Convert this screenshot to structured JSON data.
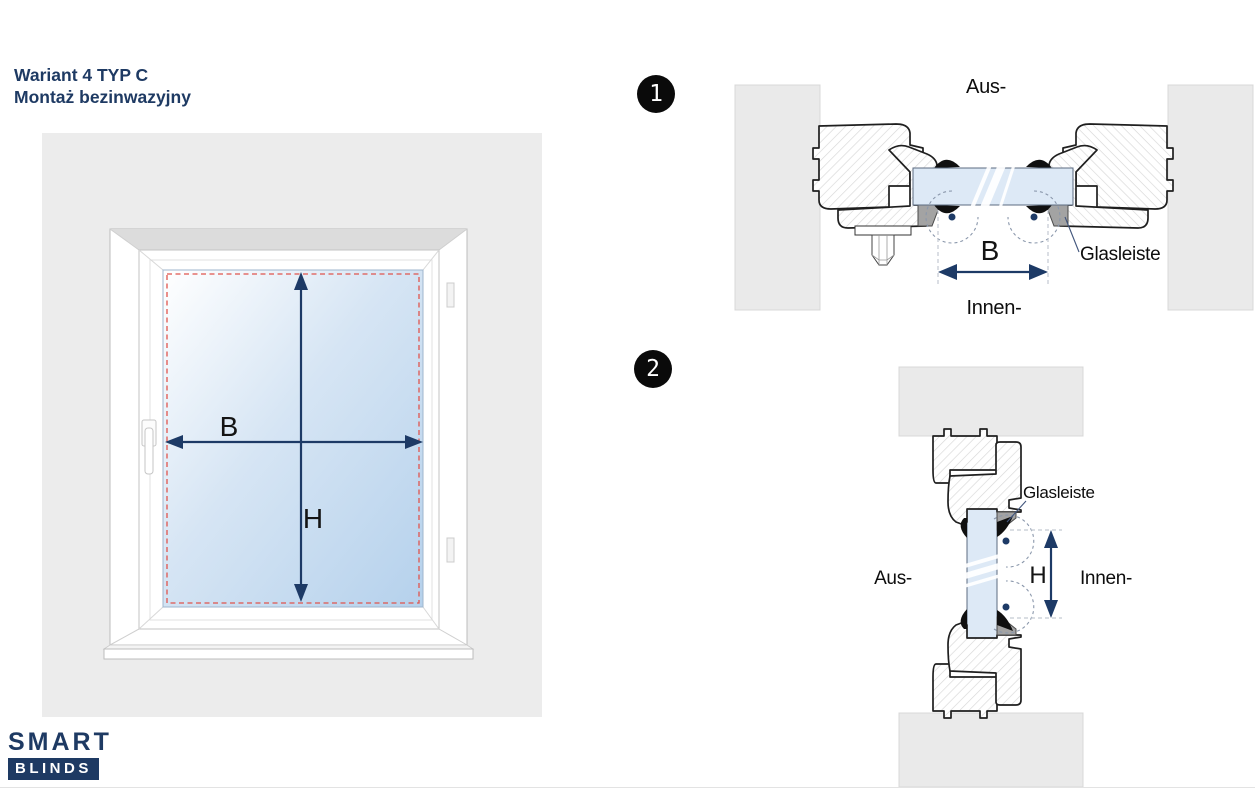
{
  "header": {
    "title_line1": "Wariant 4 TYP C",
    "title_line2": "Montaż bezinwazyjny"
  },
  "window_figure": {
    "width_label": "B",
    "height_label": "H"
  },
  "section_1": {
    "badge": "1",
    "outside_label": "Aus-",
    "inside_label": "Innen-",
    "glazing_bead_label": "Glasleiste",
    "width_label": "B"
  },
  "section_2": {
    "badge": "2",
    "outside_label": "Aus-",
    "inside_label": "Innen-",
    "glazing_bead_label": "Glasleiste",
    "height_label": "H"
  },
  "logo": {
    "line1": "SMART",
    "line2": "BLINDS"
  },
  "colors": {
    "navy": "#1e3a63",
    "dim": "#1d3a66",
    "panel": "#ececec",
    "wall": "#eaeaea",
    "glass": "#dde9f6",
    "bead": "#a3a3a3",
    "red": "#e0544d",
    "outline": "#1f1f1f",
    "hatch": "#d7d7d7",
    "badge": "#0a0a0a",
    "leader": "#41557c"
  }
}
